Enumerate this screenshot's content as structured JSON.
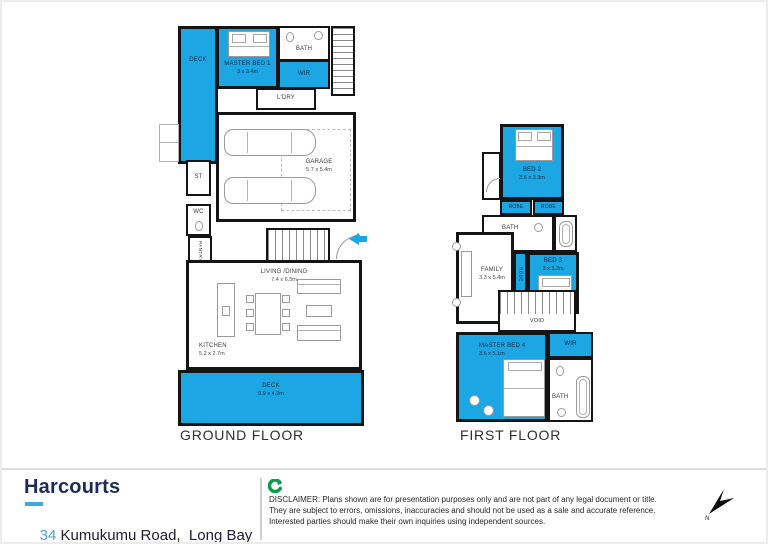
{
  "colors": {
    "plan_blue": "#1ca7e4",
    "brand_navy": "#1d2b5a",
    "brand_cyan": "#3fa9d8",
    "address_number_cyan": "#4aa3cf",
    "logo_green": "#0a9b4e"
  },
  "ground_floor": {
    "title": "GROUND FLOOR",
    "deck_top": {
      "name": "DECK"
    },
    "master_bed_1": {
      "name": "MASTER BED 1",
      "dims": "3 x 3.4m"
    },
    "bath": {
      "name": "BATH"
    },
    "wir": {
      "name": "WIR"
    },
    "laundry": {
      "name": "L'DRY"
    },
    "store": {
      "name": "ST"
    },
    "wc": {
      "name": "WC"
    },
    "pantry": {
      "name": "PANTRY"
    },
    "garage": {
      "name": "GARAGE",
      "dims": "5.7 x 5.4m"
    },
    "living_dining": {
      "name": "LIVING /DINING",
      "dims": "7.4 x 6.5m"
    },
    "kitchen": {
      "name": "KITCHEN",
      "dims": "5.2 x 2.7m"
    },
    "deck_bottom": {
      "name": "DECK",
      "dims": "9.9 x 4.2m"
    }
  },
  "first_floor": {
    "title": "FIRST FLOOR",
    "bed_2": {
      "name": "BED 2",
      "dims": "3.6 x 3.3m"
    },
    "robe_left": {
      "name": "ROBE"
    },
    "robe_right": {
      "name": "ROBE"
    },
    "bath_top": {
      "name": "BATH"
    },
    "bed_3": {
      "name": "BED 3",
      "dims": "3 x 3.2m"
    },
    "robe_vertical": {
      "name": "ROBE"
    },
    "family": {
      "name": "FAMILY",
      "dims": "3.3 x 5.4m"
    },
    "void": {
      "name": "VOID"
    },
    "master_bed_4": {
      "name": "MASTER BED 4",
      "dims": "3.6 x 5.1m"
    },
    "wir": {
      "name": "WIR"
    },
    "bath_bottom": {
      "name": "BATH"
    }
  },
  "footer": {
    "logo": "Harcourts",
    "address_number": "34",
    "address_rest": " Kumukumu Road,  Long Bay",
    "disclaimer_line1": "DISCLAIMER: Plans shown are for presentation purposes only and are not part of any legal document or title.",
    "disclaimer_line2": "They are subject to errors, omissions, inaccuracies and should not be used as a sale and accurate reference.",
    "disclaimer_line3": "Interested parties should make their own inquiries using independent sources.",
    "north_label": "N"
  }
}
